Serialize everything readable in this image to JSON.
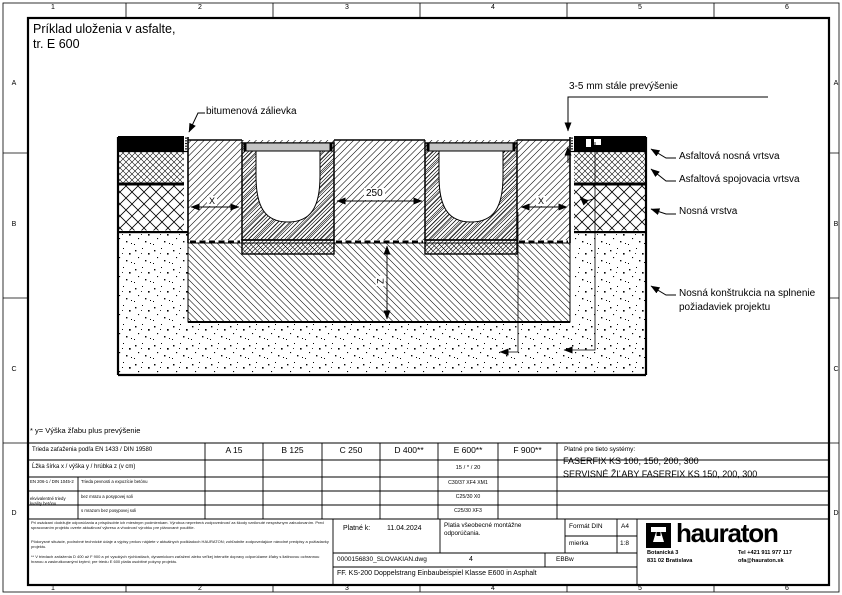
{
  "sheet": {
    "grid_cols": [
      "1",
      "2",
      "3",
      "4",
      "5",
      "6"
    ],
    "grid_rows": [
      "A",
      "B",
      "C",
      "D"
    ],
    "title_line1": "Príklad uloženia v asfalte,",
    "title_line2": "tr. E 600"
  },
  "callouts": {
    "bitumen_joint": "bitumenová zálievka",
    "elevation": "3-5 mm stále prevýšenie",
    "asphalt_base_course": "Asfaltová nosná vrtsva",
    "asphalt_binder_course": "Asfaltová spojovacia vrtsva",
    "base_course": "Nosná vrstva",
    "substructure": "Nosná konštrukcia na splnenie požiadaviek projektu"
  },
  "dimensions": {
    "x_left": "X",
    "x_right": "X",
    "spacing": "250",
    "depth": "Z"
  },
  "footnote": "* y= Výška žľabu plus prevýšenie",
  "load_table": {
    "class_row_label": "Trieda zaťaženia podľa EN 1433 / DIN 19580",
    "classes": [
      "A 15",
      "B 125",
      "C 250",
      "D 400**",
      "E 600**",
      "F 900**"
    ],
    "dim_row_label": "Ĺžka šírka x / výška y / hrúbka z (v cm)",
    "dim_value_e600": "15 / * / 20",
    "concrete_norm": "EN 206-1 / DIN 1045-2",
    "concrete_note": "ekvivalentné triedy kvality betónu",
    "exposure_rows": [
      {
        "label": "Trieda pevnosti a expozície betónu",
        "e600": "C30/37 XF4 XM1"
      },
      {
        "label": "bez mrazu a posypovej soli",
        "e600": "C25/30 X0"
      },
      {
        "label": "s mrazom bez posypovej soli",
        "e600": "C25/30 XF3"
      }
    ],
    "systems_heading": "Platné pre tieto systémy:",
    "systems_line1": "FASERFIX KS 100, 150, 200, 300",
    "systems_line2": "SERVISNÉ ŽĽABY FASERFIX KS 150, 200, 300"
  },
  "title_block": {
    "disclaimer_p1": "Pri osádzaní dodržujte odporúčania a prispôsobte ich miestnym podmienkam. Výrobca nepreberá zodpovednosť za škody vzniknuté nesprávnym zabudovaním. Pred spracovaním projektu overte aktuálnosť výkresu a vhodnosť výrobku pre plánované použitie.",
    "disclaimer_p2": "Pôdorysné situácie, podrobné technické údaje a výpisy prvkov nájdete v aktuálnych podkladoch HAURATON; zohľadnite zodpovedajúce národné predpisy a požiadavky projektu.",
    "disclaimer_p3": "** V triedach zaťaženia D 400 až F 900 a pri vysokých rýchlostiach, dynamickom zaťažení alebo veľkej intenzite dopravy odporúčame žľaby s liatinovou ochrannou hranou a zaskrutkovanými krytmi; pre triedu E 600 platia osobitné pokyny projektu.",
    "valid_label": "Platné k:",
    "valid_date": "11.04.2024",
    "recommendation": "Platia všeobecné montážne odporúčania.",
    "format_label": "Formát DIN",
    "format_value": "A4",
    "scale_label": "mierka",
    "scale_value": "1:8",
    "file_name": "0000156830_SLOVAKIAN.dwg",
    "sheet_no": "4",
    "doc_code": "EBBw",
    "description": "FF. KS-200 Doppelstrang Einbaubeispiel Klasse E600 in Asphalt"
  },
  "brand": {
    "logo_text": "hauraton",
    "address_line1": "Botanická 3",
    "address_line2": "831 02 Bratislava",
    "phone": "Tel +421 911 977 117",
    "email": "ofa@hauraton.sk"
  }
}
